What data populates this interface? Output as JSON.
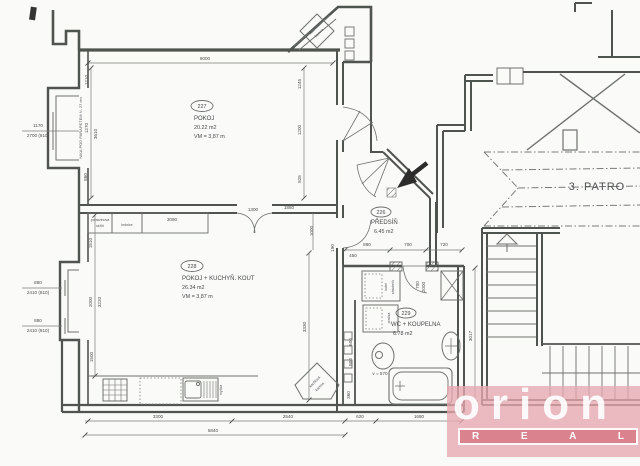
{
  "floor": {
    "label": "3. PATRO"
  },
  "rooms": {
    "r227": {
      "number": "227",
      "name": "POKOJ",
      "area": "20.22 m2",
      "vm": "VM = 3,87 m"
    },
    "r228": {
      "number": "228",
      "name": "POKOJ + KUCHYŇ. KOUT",
      "area": "26.34 m2",
      "vm": "VM = 3,87 m"
    },
    "r226": {
      "number": "226",
      "name": "PŘEDSÍŇ",
      "area": "6.45 m2"
    },
    "r229": {
      "number": "229",
      "name": "WC + KOUPELNA",
      "area": "6.78 m2"
    }
  },
  "labels": {
    "pantry1": "potravinová",
    "pantry2": "skříň",
    "fridge": "lednice",
    "dishwasher": "myčka",
    "stove1": "kachlová",
    "stove2": "kamna",
    "boiler": "kotel",
    "tank": "zásobník",
    "washer": "pračka",
    "tub_height": "v = 570",
    "nika": "NIKA POD PARAPETEM N. 27 cm"
  },
  "dimensions": [
    {
      "t": "6000",
      "x": 205,
      "y": 60,
      "r": 0
    },
    {
      "t": "1245",
      "x": 301,
      "y": 84,
      "r": -90
    },
    {
      "t": "1200",
      "x": 301,
      "y": 130,
      "r": -90
    },
    {
      "t": "825",
      "x": 301,
      "y": 179,
      "r": -90
    },
    {
      "t": "1210",
      "x": 88,
      "y": 80,
      "r": -90
    },
    {
      "t": "1270",
      "x": 88,
      "y": 128,
      "r": -90
    },
    {
      "t": "3610",
      "x": 97,
      "y": 134,
      "r": -90
    },
    {
      "t": "860",
      "x": 87,
      "y": 177,
      "r": -90
    },
    {
      "t": "1170",
      "x": 38,
      "y": 127,
      "r": 0
    },
    {
      "t": "2700 (810)",
      "x": 38,
      "y": 137,
      "r": 0
    },
    {
      "t": "880",
      "x": 38,
      "y": 284,
      "r": 0
    },
    {
      "t": "2410 (810)",
      "x": 38,
      "y": 294,
      "r": 0
    },
    {
      "t": "880",
      "x": 38,
      "y": 322,
      "r": 0
    },
    {
      "t": "2410 (810)",
      "x": 38,
      "y": 332,
      "r": 0
    },
    {
      "t": "1510",
      "x": 92,
      "y": 243,
      "r": -90
    },
    {
      "t": "2000",
      "x": 92,
      "y": 302,
      "r": -90
    },
    {
      "t": "3220",
      "x": 101,
      "y": 302,
      "r": -90
    },
    {
      "t": "1500",
      "x": 93,
      "y": 357,
      "r": -90
    },
    {
      "t": "3090",
      "x": 172,
      "y": 221,
      "r": 0
    },
    {
      "t": "1300",
      "x": 253,
      "y": 211,
      "r": 0
    },
    {
      "t": "1880",
      "x": 289,
      "y": 209,
      "r": 0
    },
    {
      "t": "1000",
      "x": 313,
      "y": 231,
      "r": -90
    },
    {
      "t": "3330",
      "x": 306,
      "y": 327,
      "r": -90
    },
    {
      "t": "190",
      "x": 334,
      "y": 248,
      "r": -90
    },
    {
      "t": "880",
      "x": 367,
      "y": 246,
      "r": 0
    },
    {
      "t": "700",
      "x": 408,
      "y": 246,
      "r": 0
    },
    {
      "t": "720",
      "x": 444,
      "y": 246,
      "r": 0
    },
    {
      "t": "450",
      "x": 353,
      "y": 257,
      "r": 0
    },
    {
      "t": "700",
      "x": 419,
      "y": 285,
      "r": -90
    },
    {
      "t": "2000",
      "x": 425,
      "y": 287,
      "r": -90
    },
    {
      "t": "3017",
      "x": 472,
      "y": 336,
      "r": -90
    },
    {
      "t": "3300",
      "x": 158,
      "y": 418,
      "r": 0
    },
    {
      "t": "2540",
      "x": 288,
      "y": 418,
      "r": 0
    },
    {
      "t": "5840",
      "x": 213,
      "y": 432,
      "r": 0
    },
    {
      "t": "620",
      "x": 360,
      "y": 418,
      "r": 0
    },
    {
      "t": "1680",
      "x": 419,
      "y": 418,
      "r": 0
    },
    {
      "t": "360",
      "x": 350,
      "y": 395,
      "r": -90
    },
    {
      "t": "600",
      "x": 352,
      "y": 342,
      "r": -90
    },
    {
      "t": "800",
      "x": 352,
      "y": 362,
      "r": -90
    }
  ],
  "logo": {
    "brand": "orion",
    "letters": [
      "R",
      "E",
      "A",
      "L"
    ]
  },
  "colors": {
    "wall": "#50544f",
    "thin_line": "#6d716d",
    "text": "#45494b",
    "watermark_pink": "#e7a8b0",
    "watermark_red": "#d67684",
    "watermark_text": "#ffffff"
  }
}
